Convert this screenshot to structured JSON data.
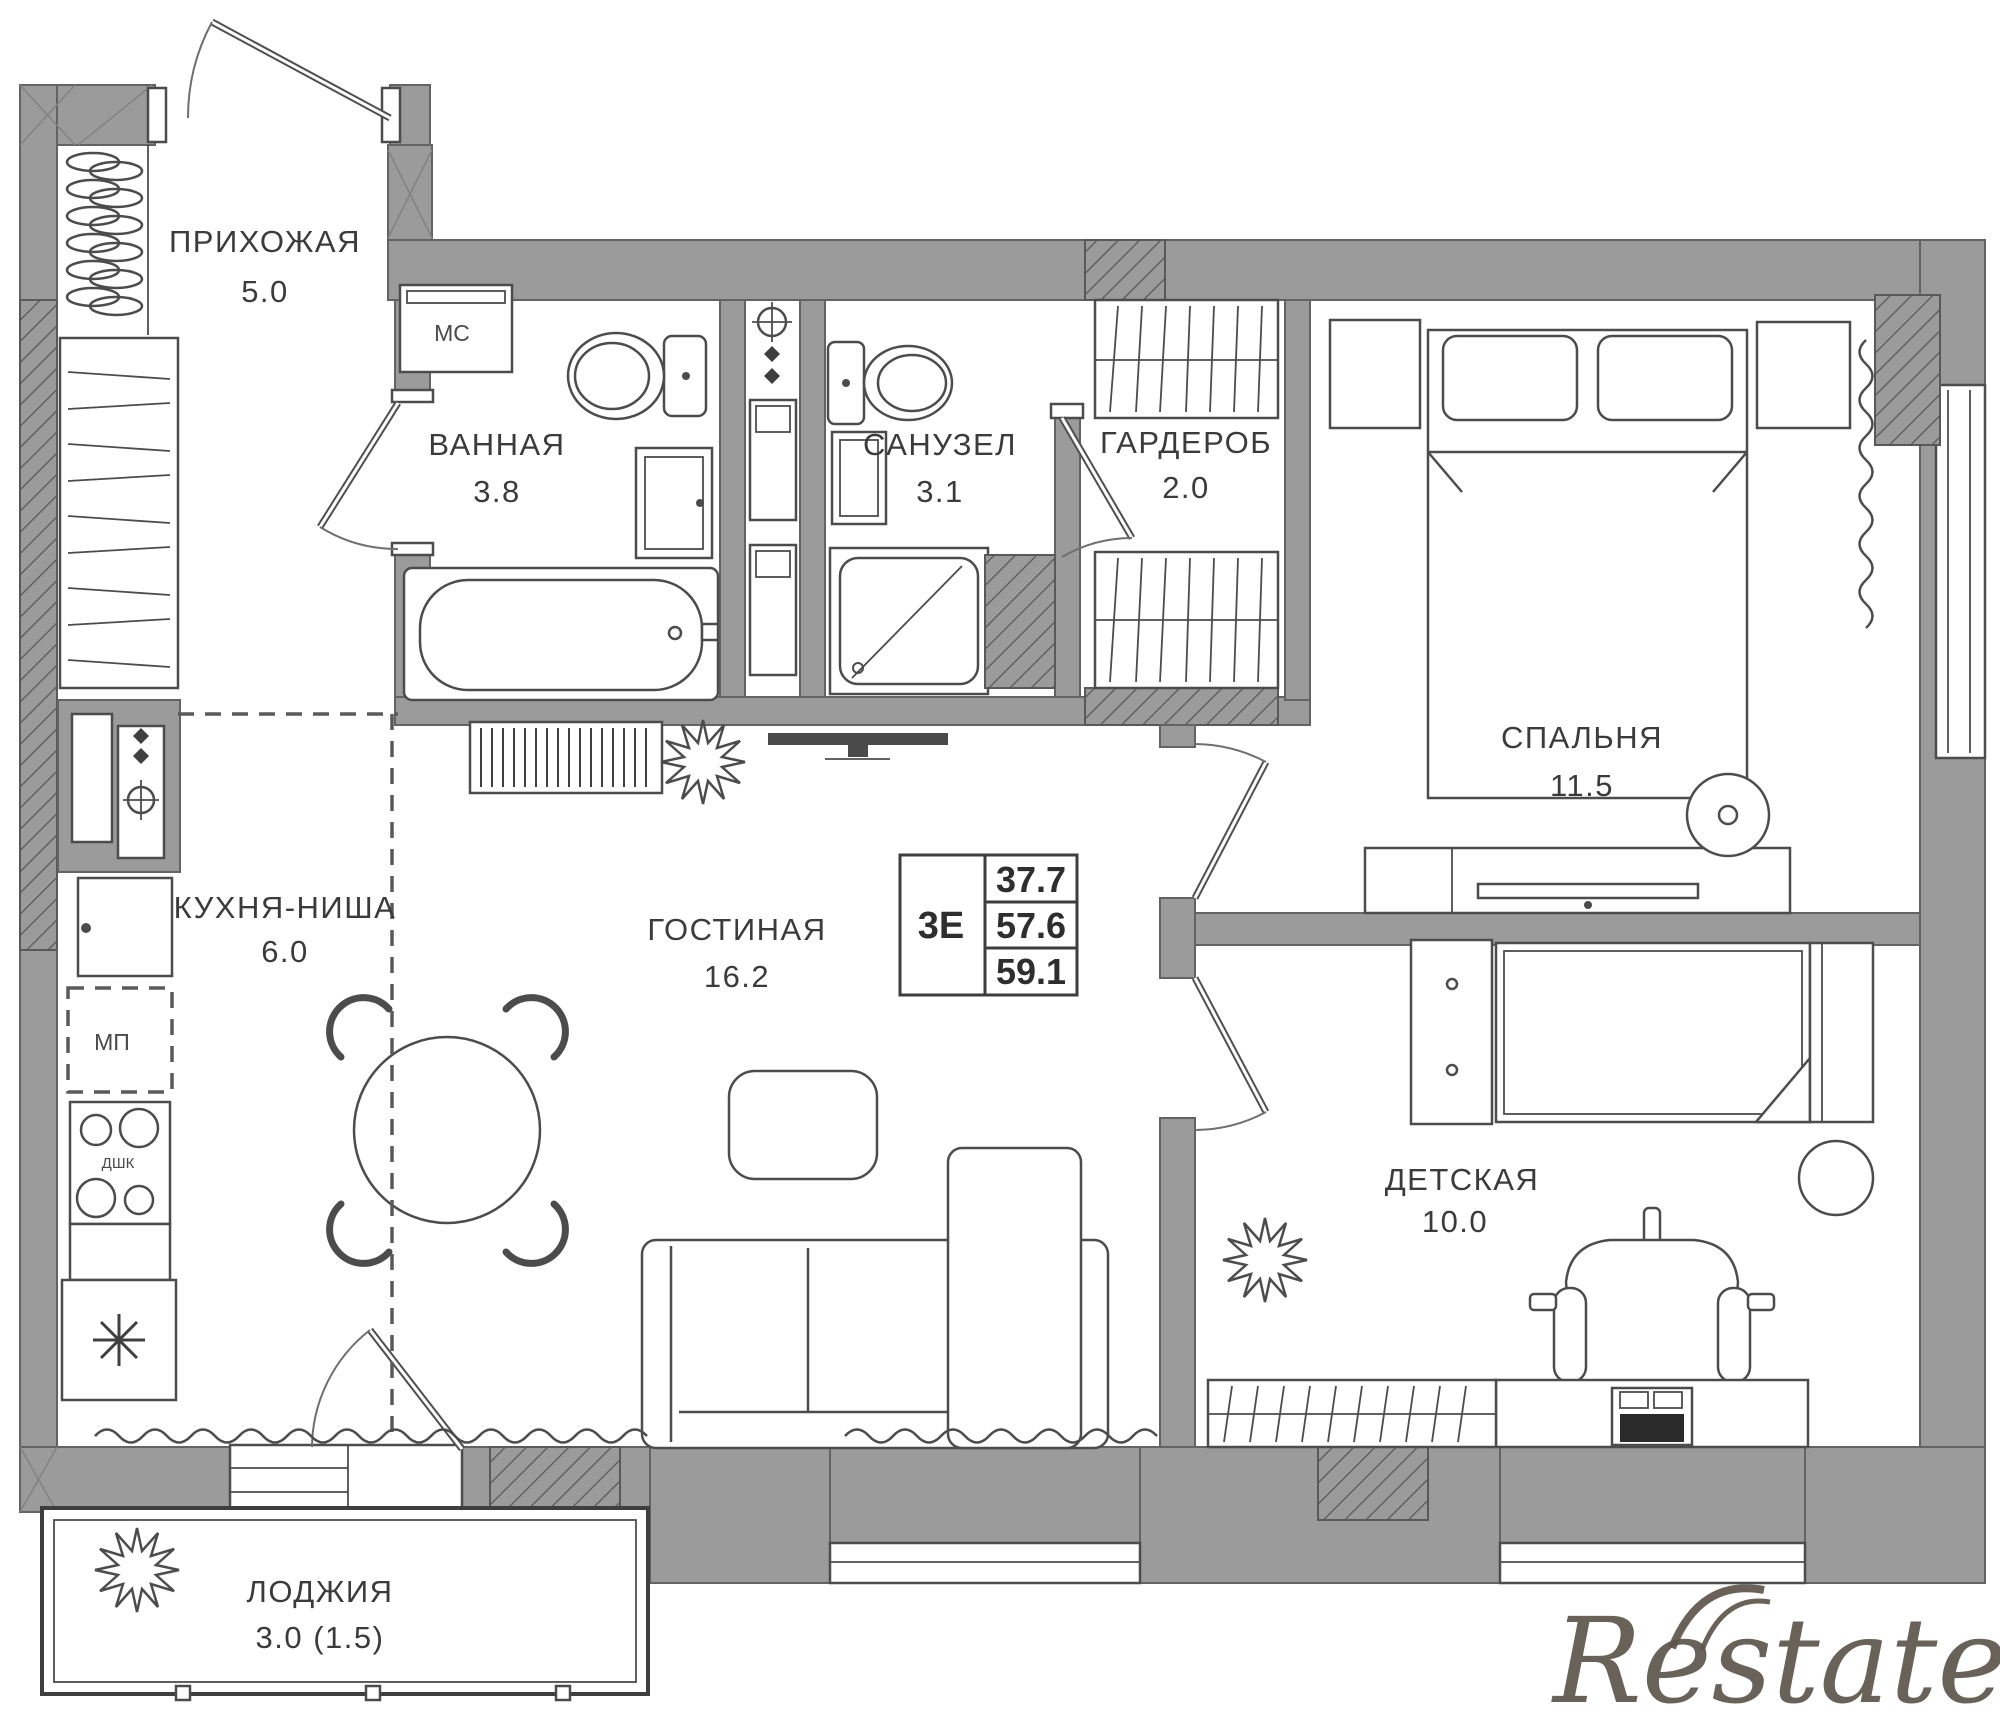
{
  "rooms": [
    {
      "id": "hallway",
      "name": "ПРИХОЖАЯ",
      "area": "5.0"
    },
    {
      "id": "bathroom",
      "name": "ВАННАЯ",
      "area": "3.8"
    },
    {
      "id": "toilet",
      "name": "САНУЗЕЛ",
      "area": "3.1"
    },
    {
      "id": "wardrobe",
      "name": "ГАРДЕРОБ",
      "area": "2.0"
    },
    {
      "id": "bedroom",
      "name": "СПАЛЬНЯ",
      "area": "11.5"
    },
    {
      "id": "kitchen",
      "name": "КУХНЯ-НИША",
      "area": "6.0"
    },
    {
      "id": "living",
      "name": "ГОСТИНАЯ",
      "area": "16.2"
    },
    {
      "id": "kids",
      "name": "ДЕТСКАЯ",
      "area": "10.0"
    },
    {
      "id": "loggia",
      "name": "ЛОДЖИЯ",
      "area": "3.0 (1.5)"
    }
  ],
  "info_box": {
    "type_label": "3Е",
    "values": [
      "37.7",
      "57.6",
      "59.1"
    ]
  },
  "equipment": {
    "washer_label": "МС",
    "appliance_slot_label": "МП",
    "oven_label": "ДШК"
  },
  "watermark": {
    "text": "Restate"
  },
  "colors": {
    "wall_fill": "#9b9b9b",
    "wall_outline": "#636363",
    "line": "#4c4c4c",
    "text": "#3b3b3b",
    "watermark": "#5d554b",
    "background": "#ffffff"
  }
}
